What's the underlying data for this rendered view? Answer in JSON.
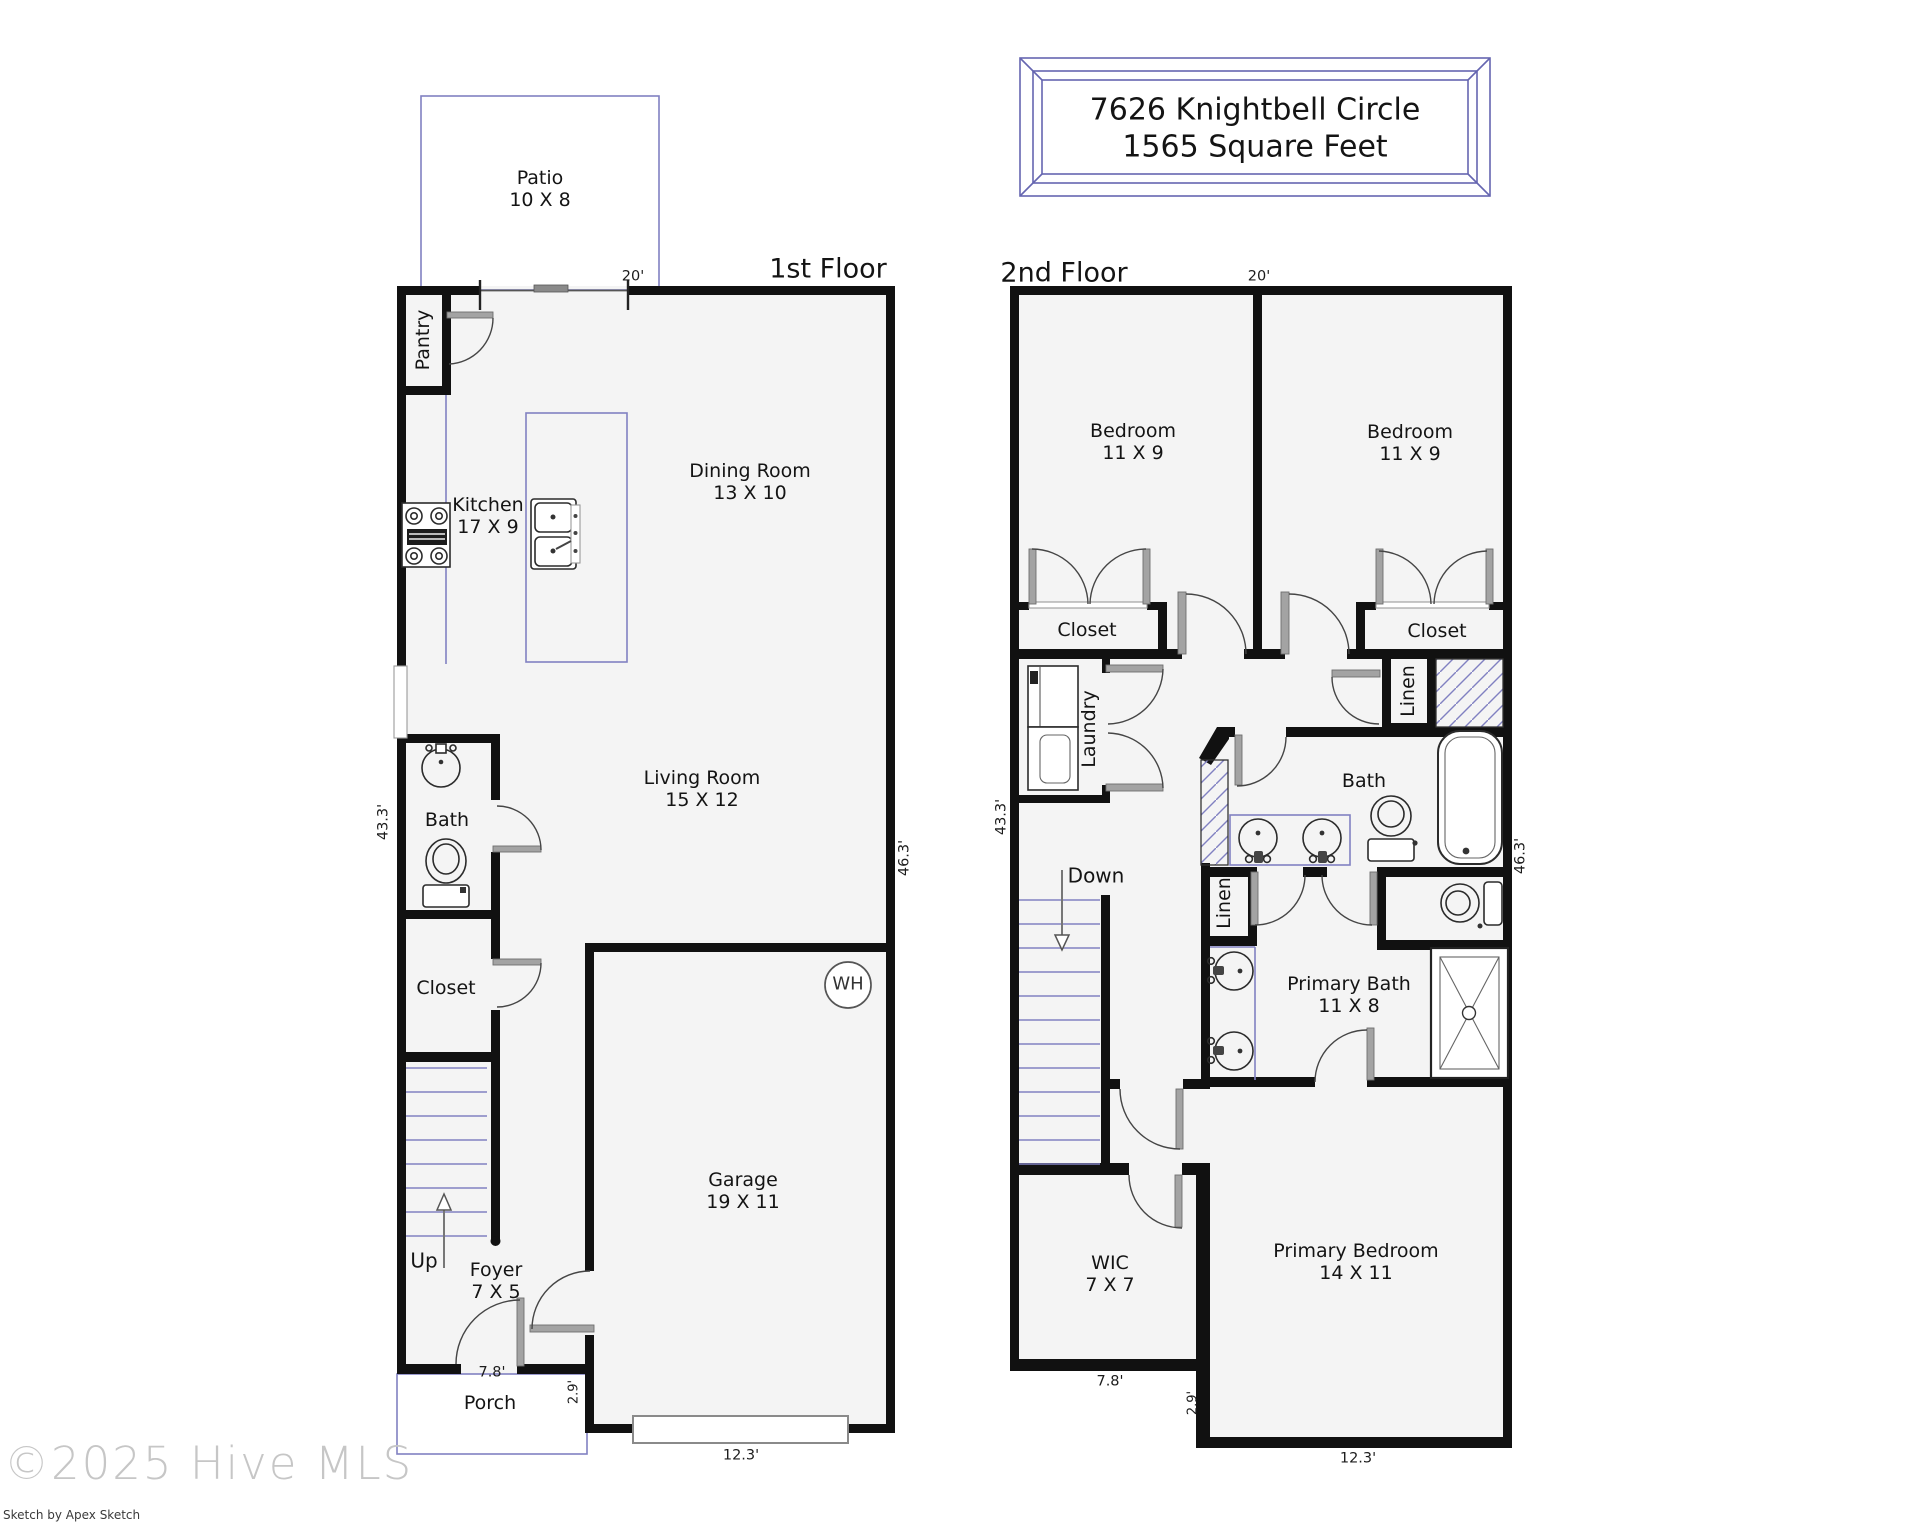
{
  "header": {
    "address_line1": "7626 Knightbell Circle",
    "address_line2": "1565 Square Feet"
  },
  "floor1": {
    "title": "1st Floor",
    "rooms": {
      "patio": {
        "name": "Patio",
        "size": "10 X 8"
      },
      "pantry": {
        "name": "Pantry"
      },
      "kitchen": {
        "name": "Kitchen",
        "size": "17 X 9"
      },
      "dining": {
        "name": "Dining Room",
        "size": "13 X 10"
      },
      "living": {
        "name": "Living Room",
        "size": "15 X 12"
      },
      "bath": {
        "name": "Bath"
      },
      "closet": {
        "name": "Closet"
      },
      "garage": {
        "name": "Garage",
        "size": "19 X 11"
      },
      "foyer": {
        "name": "Foyer",
        "size": "7 X 5"
      },
      "porch": {
        "name": "Porch"
      }
    },
    "annotations": {
      "up": "Up",
      "water_heater": "WH"
    },
    "dims": {
      "top": "20'",
      "left": "43.3'",
      "right": "46.3'",
      "porch_width": "7.8'",
      "step": "2.9'",
      "garage_width": "12.3'"
    }
  },
  "floor2": {
    "title": "2nd Floor",
    "rooms": {
      "bedroom1": {
        "name": "Bedroom",
        "size": "11 X 9"
      },
      "bedroom2": {
        "name": "Bedroom",
        "size": "11 X 9"
      },
      "closet1": {
        "name": "Closet"
      },
      "closet2": {
        "name": "Closet"
      },
      "laundry": {
        "name": "Laundry"
      },
      "linen1": {
        "name": "Linen"
      },
      "linen2": {
        "name": "Linen"
      },
      "bath": {
        "name": "Bath"
      },
      "primary_bath": {
        "name": "Primary Bath",
        "size": "11 X 8"
      },
      "wic": {
        "name": "WIC",
        "size": "7 X 7"
      },
      "primary_bedroom": {
        "name": "Primary Bedroom",
        "size": "14 X 11"
      }
    },
    "annotations": {
      "down": "Down"
    },
    "dims": {
      "top": "20'",
      "left": "43.3'",
      "right": "46.3'",
      "wic_width": "7.8'",
      "step": "2.9'",
      "bedroom_width": "12.3'"
    }
  },
  "footer": {
    "copyright": "©2025 Hive MLS",
    "credit": "Sketch by Apex Sketch"
  },
  "colors": {
    "wall": "#111111",
    "accent": "#8181c1",
    "fixture": "#2b2b2b",
    "fill": "#f4f4f4",
    "title_border": "#6666b0"
  }
}
